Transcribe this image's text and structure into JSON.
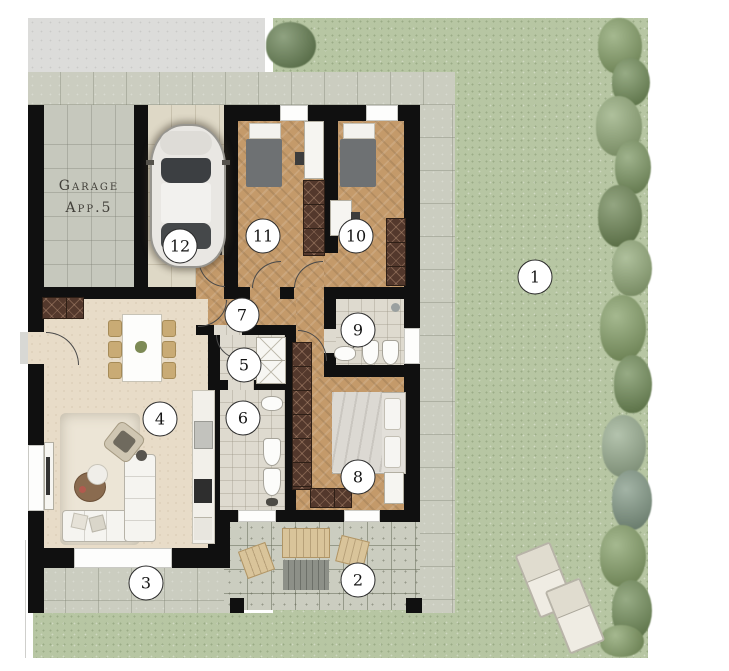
{
  "plan": {
    "garage_label": {
      "line1": "Garage",
      "line2": "App.5"
    },
    "markers": [
      {
        "number": "1",
        "x": 535,
        "y": 277
      },
      {
        "number": "2",
        "x": 358,
        "y": 580
      },
      {
        "number": "3",
        "x": 146,
        "y": 583
      },
      {
        "number": "4",
        "x": 160,
        "y": 419
      },
      {
        "number": "5",
        "x": 244,
        "y": 365
      },
      {
        "number": "6",
        "x": 243,
        "y": 418
      },
      {
        "number": "7",
        "x": 242,
        "y": 315
      },
      {
        "number": "8",
        "x": 358,
        "y": 477
      },
      {
        "number": "9",
        "x": 358,
        "y": 330
      },
      {
        "number": "10",
        "x": 356,
        "y": 236
      },
      {
        "number": "11",
        "x": 263,
        "y": 236
      },
      {
        "number": "12",
        "x": 180,
        "y": 246
      }
    ]
  },
  "palette": {
    "grass": "#b7c6a3",
    "drive": "#dcdcda",
    "tile": "#cbcdc0",
    "garagetile": "#c6c8bd",
    "beigetile": "#ded8c6",
    "bath": "#dedacf",
    "wood": "#c49a6a",
    "livingf": "#e8dcc8",
    "wall": "#101010",
    "wardrobe": "#53382c",
    "tan": "#d9c49a"
  }
}
